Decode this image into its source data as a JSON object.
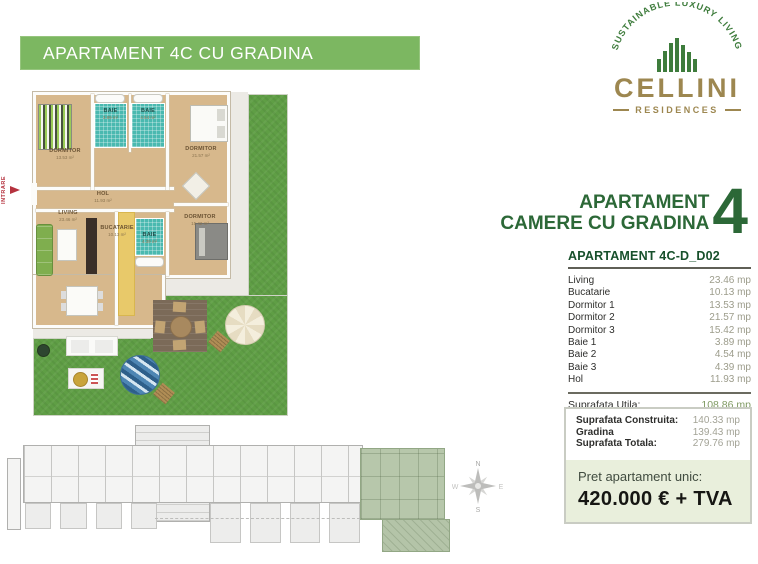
{
  "banner": {
    "title": "APARTAMENT 4C CU GRADINA"
  },
  "logo": {
    "arc_text": "SUSTAINABLE LUXURY LIVING",
    "brand": "CELLINI",
    "subtitle": "RESIDENCES"
  },
  "heading": {
    "line1": "APARTAMENT",
    "line2": "CAMERE CU GRADINA",
    "number": "4"
  },
  "unit": {
    "title": "APARTAMENT 4C-D_D02",
    "rooms": [
      {
        "label": "Living",
        "value": "23.46 mp"
      },
      {
        "label": "Bucatarie",
        "value": "10.13 mp"
      },
      {
        "label": "Dormitor 1",
        "value": "13.53 mp"
      },
      {
        "label": "Dormitor 2",
        "value": "21.57 mp"
      },
      {
        "label": "Dormitor 3",
        "value": "15.42 mp"
      },
      {
        "label": "Baie 1",
        "value": "3.89 mp"
      },
      {
        "label": "Baie 2",
        "value": "4.54 mp"
      },
      {
        "label": "Baie 3",
        "value": "4.39 mp"
      },
      {
        "label": "Hol",
        "value": "11.93 mp"
      }
    ],
    "utila_label": "Suprafata Utila:",
    "utila_value": "108.86 mp",
    "summary": [
      {
        "label": "Suprafata Construita:",
        "value": "140.33 mp"
      },
      {
        "label": "Gradina",
        "value": "139.43 mp"
      },
      {
        "label": "Suprafata Totala:",
        "value": "279.76 mp"
      }
    ],
    "price_label": "Pret apartament unic:",
    "price_value": "420.000 € + TVA"
  },
  "floorplan": {
    "entrance": "INTRARE",
    "rooms": [
      {
        "name": "DORMITOR",
        "area": "13.53 m²"
      },
      {
        "name": "BAIE",
        "area": "3.89 m²"
      },
      {
        "name": "BAIE",
        "area": "4.54 m²"
      },
      {
        "name": "DORMITOR",
        "area": "21.57 m²"
      },
      {
        "name": "HOL",
        "area": "11.93 m²"
      },
      {
        "name": "LIVING",
        "area": "23.46 m²"
      },
      {
        "name": "BUCATARIE",
        "area": "10.13 m²"
      },
      {
        "name": "BAIE",
        "area": "4.39 m²"
      },
      {
        "name": "DORMITOR",
        "area": "15.42 m²"
      }
    ]
  },
  "compass": {
    "north": "N",
    "south": "S",
    "east": "E",
    "west": "W"
  },
  "colors": {
    "accent_green": "#7cb761",
    "dark_green": "#2c6837",
    "brand_gold": "#9d8750",
    "price_bg": "#e9efdc",
    "grass_green": "#5f9e45",
    "bath_teal": "#4ab9b0"
  }
}
